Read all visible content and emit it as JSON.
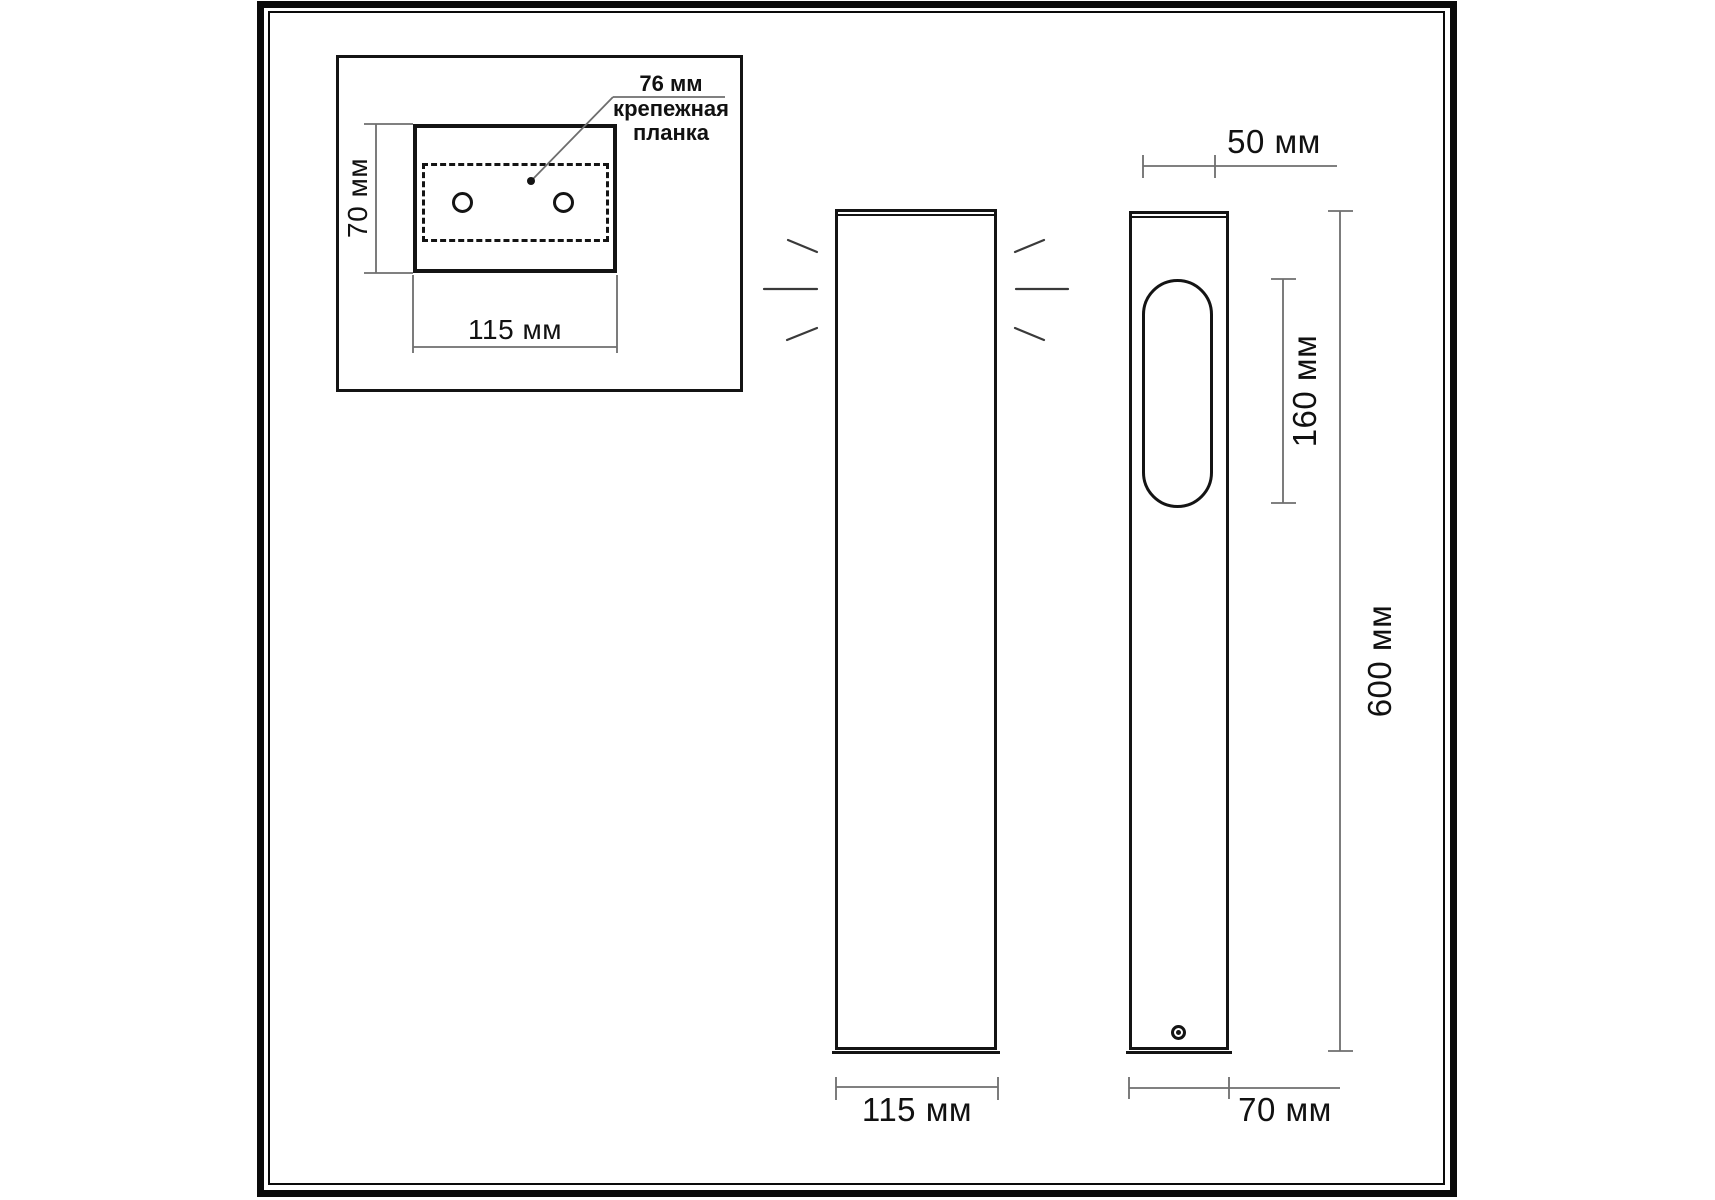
{
  "drawing": {
    "title": "Bollard light dimensional drawing",
    "units": "мм"
  },
  "inset_view": {
    "plate_width_label": "76 мм",
    "plate_note": "крепежная\nпланка",
    "height_label": "70 мм",
    "width_label": "115 мм"
  },
  "front_view": {
    "width_label": "115 мм"
  },
  "side_view": {
    "lens_width_label": "50 мм",
    "lens_height_label": "160 мм",
    "total_height_label": "600 мм",
    "depth_label": "70 мм"
  },
  "colors": {
    "background": "#ffffff",
    "object_line": "#141414",
    "dimension_line": "#6e6e6e",
    "frame": "#0a0a0a"
  }
}
